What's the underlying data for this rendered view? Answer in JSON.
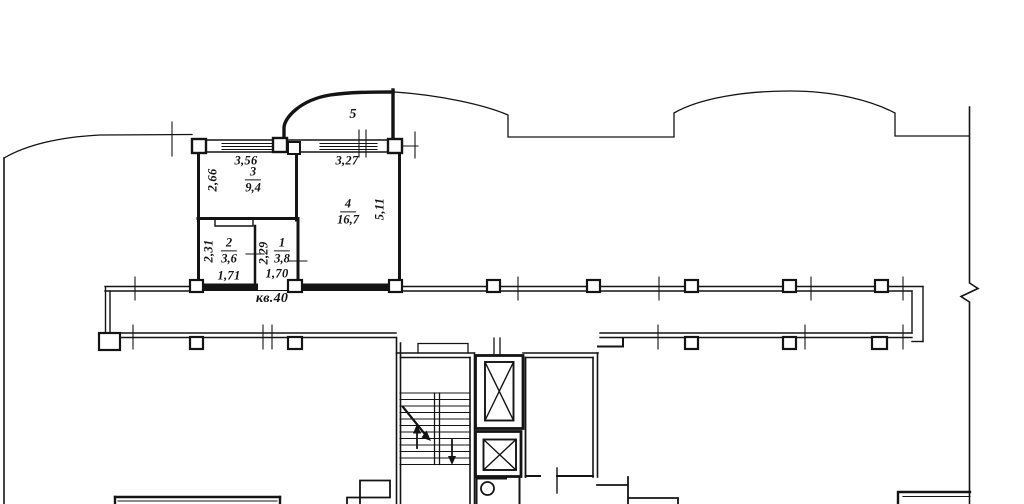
{
  "page": {
    "background_color": "#ffffff",
    "line_color": "#141414"
  },
  "floor_plan": {
    "apartment_number_label": "кв.40",
    "balcony": {
      "number": "5"
    },
    "rooms": {
      "room3": {
        "number": "3",
        "area": "9,4",
        "dim_width": "3,56",
        "dim_height": "2,66"
      },
      "room4": {
        "number": "4",
        "area": "16,7",
        "dim_width": "3,27",
        "dim_height": "5,11"
      },
      "room2": {
        "number": "2",
        "area": "3,6",
        "dim_height": "2,31",
        "dim_width": "1,71"
      },
      "room1": {
        "number": "1",
        "area": "3,8",
        "dim_height": "2,29",
        "dim_width": "1,70"
      }
    }
  }
}
